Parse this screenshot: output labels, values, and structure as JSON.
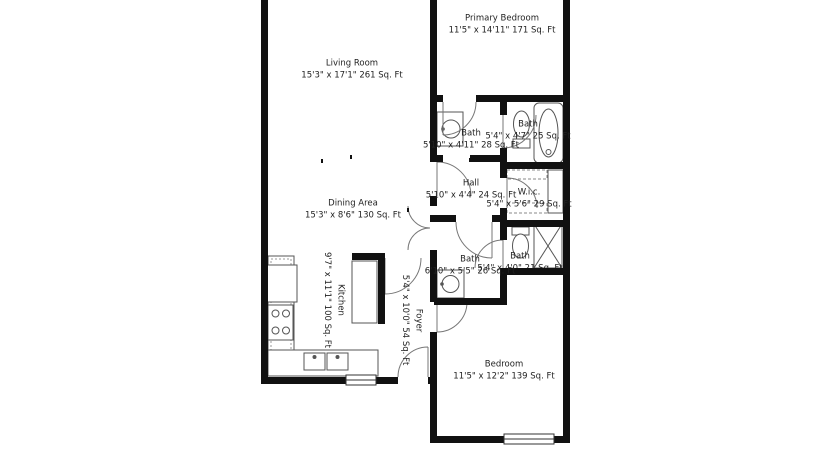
{
  "plan": {
    "type": "floor-plan",
    "rooms": [
      {
        "id": "living_room",
        "name": "Living Room",
        "dims": "15'3\" x 17'1\" 261 Sq. Ft"
      },
      {
        "id": "primary_bedroom",
        "name": "Primary Bedroom",
        "dims": "11'5\" x 14'11\" 171 Sq. Ft"
      },
      {
        "id": "bath_upper_left",
        "name": "Bath",
        "dims": "5'10\" x 4'11\" 28 Sq. Ft"
      },
      {
        "id": "bath_upper_right",
        "name": "Bath",
        "dims": "5'4\" x 4'7\" 25 Sq. Ft"
      },
      {
        "id": "hall",
        "name": "Hall",
        "dims": "5'10\" x 4'4\" 24 Sq. Ft"
      },
      {
        "id": "walk_in_closet",
        "name": "W.i.c.",
        "dims": "5'4\" x 5'6\" 29 Sq. Ft"
      },
      {
        "id": "bath_lower_left",
        "name": "Bath",
        "dims": "6'10\" x 5'5\" 26 Sq. Ft"
      },
      {
        "id": "bath_lower_right",
        "name": "Bath",
        "dims": "5'4\" x 4'0\" 21 Sq. Ft"
      },
      {
        "id": "dining_area",
        "name": "Dining Area",
        "dims": "15'3\" x 8'6\" 130 Sq. Ft"
      },
      {
        "id": "kitchen",
        "name": "Kitchen",
        "dims": "9'7\" x 11'1\" 100 Sq. Ft"
      },
      {
        "id": "foyer",
        "name": "Foyer",
        "dims": "5'4\" x 10'0\" 54 Sq. Ft"
      },
      {
        "id": "bedroom",
        "name": "Bedroom",
        "dims": "11'5\" x 12'2\" 139 Sq. Ft"
      }
    ],
    "colors": {
      "wall": "#111111",
      "fixture_stroke": "#555555",
      "text": "#222222",
      "background": "#ffffff"
    }
  }
}
